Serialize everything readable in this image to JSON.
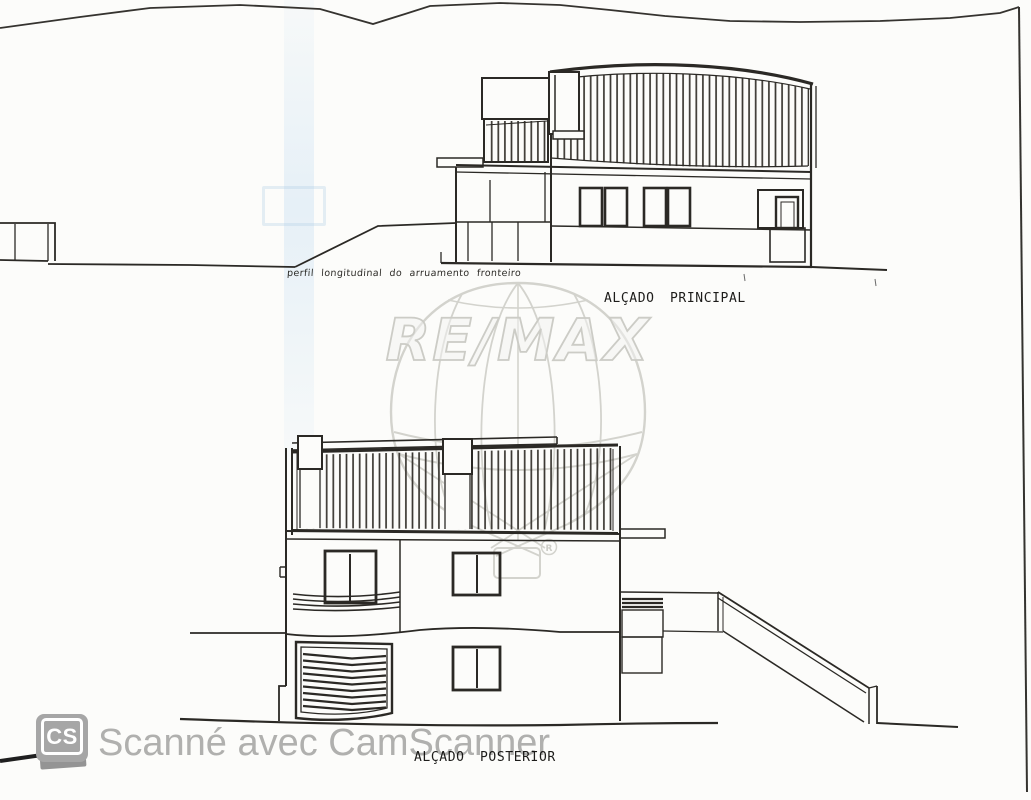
{
  "labels": {
    "street_profile": "perfil longitudinal do arruamento fronteiro",
    "main_elevation": "ALÇADO PRINCIPAL",
    "rear_elevation": "ALÇADO POSTERIOR"
  },
  "watermarks": {
    "remax": {
      "text": "RE/MAX",
      "registered": "R"
    },
    "camscanner": {
      "badge": "CS",
      "caption": "Scanné avec CamScanner"
    }
  },
  "colors": {
    "paper": "#fcfcfa",
    "ink": "#2b2925",
    "remax_gray": "#cfcfc9",
    "camscanner_gray": "#b2b2b2",
    "scan_streak": "#d8e6f1"
  }
}
